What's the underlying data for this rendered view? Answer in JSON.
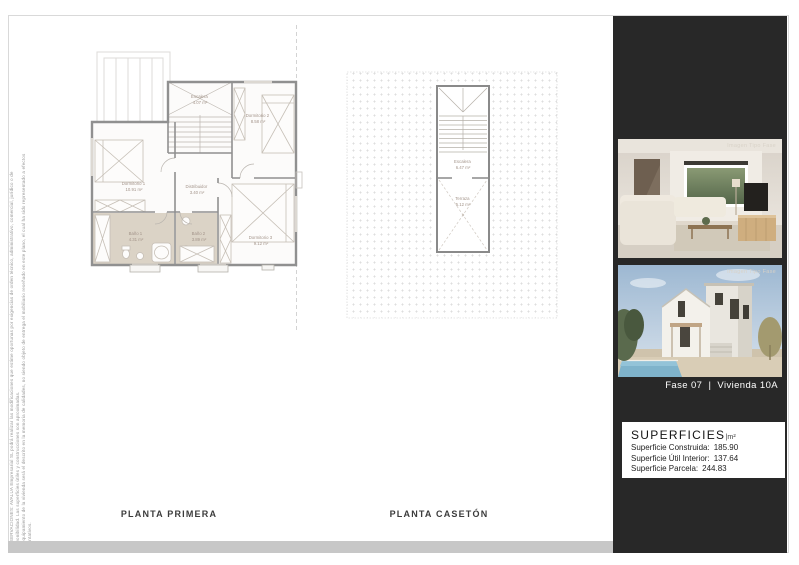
{
  "page": {
    "disclaimer_line1": "OBSERVACIONES: AVALUA Empresarial SL podrá realizar las modificaciones que estime oportunas por exigencias de orden técnico, administrativo, comercial, jurídico o de disponibilidad. Las superficies útiles y construcciones son aproximadas.",
    "disclaimer_line2": "El equipamiento de la vivienda será el descrito en la memoria de calidades, no siendo objeto de entrega el mobiliario reseñado en este plano, el cual ha sido representado a efectos orientativos."
  },
  "plans": {
    "planta_primera": {
      "title": "PLANTA PRIMERA",
      "rooms": [
        {
          "name": "Escalera",
          "area": "4.07 m²"
        },
        {
          "name": "Dormitorio 1",
          "area": "10.91 m²"
        },
        {
          "name": "Dormitorio 2",
          "area": "8.58 m²"
        },
        {
          "name": "Distribuidor",
          "area": "3.40 m²"
        },
        {
          "name": "Baño 1",
          "area": "4.31 m²"
        },
        {
          "name": "Baño 2",
          "area": "3.89 m²"
        },
        {
          "name": "Dormitorio 3",
          "area": "9.12 m²"
        }
      ]
    },
    "planta_caseton": {
      "title": "PLANTA CASETÓN",
      "rooms": [
        {
          "name": "Escalera",
          "area": "6.47 m²"
        },
        {
          "name": "Terraza",
          "area": "5.12 m²"
        }
      ]
    }
  },
  "sidebar": {
    "photos": [
      {
        "watermark": "Imagen Tipo Fase"
      },
      {
        "watermark": "Imagen Tipo Fase"
      }
    ],
    "caption": "Fase 07  |  Vivienda 10A",
    "surfaces": {
      "title": "SUPERFICIES",
      "unit": "|m²",
      "rows": [
        {
          "label": "Superficie Construida:",
          "value": "185.90"
        },
        {
          "label": "Superficie Útil Interior:",
          "value": "137.64"
        },
        {
          "label": "Superficie Parcela:",
          "value": "244.83"
        }
      ]
    }
  },
  "colors": {
    "panel": "#282828",
    "footer_bar": "#c7c7c7",
    "bath_floor": "#dbd3c6",
    "wall": "#909090"
  }
}
